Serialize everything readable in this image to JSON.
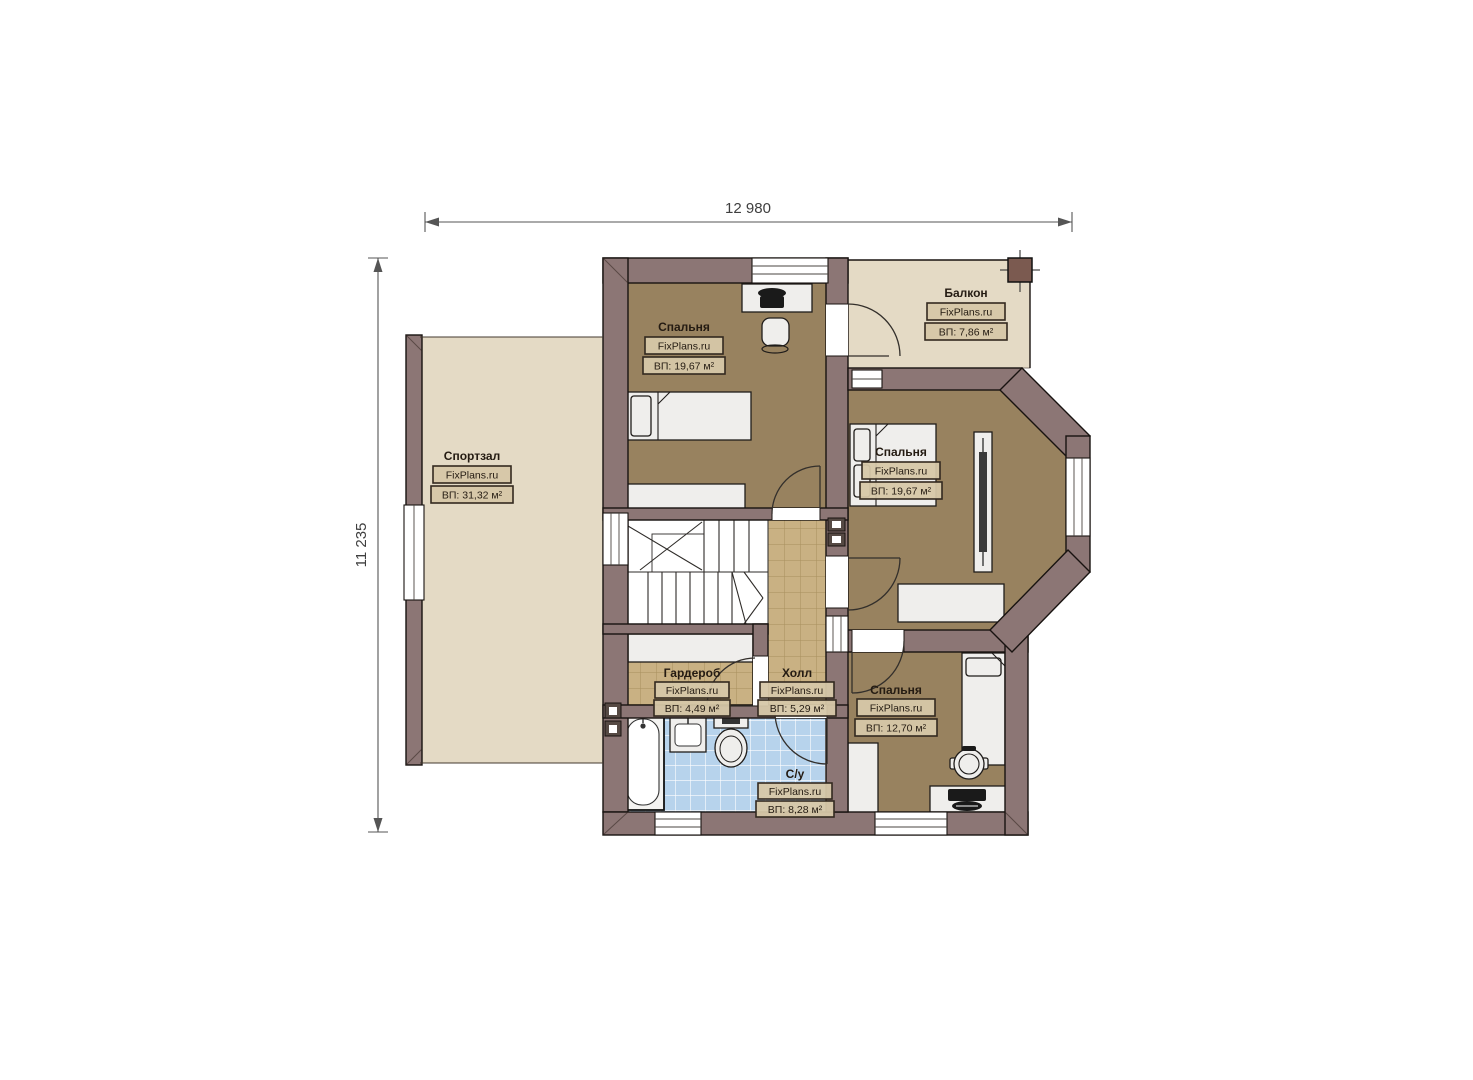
{
  "dimensions": {
    "width_total": "12 980",
    "height_total": "11 235"
  },
  "rooms": [
    {
      "key": "gym",
      "name": "Спортзал",
      "brand": "FixPlans.ru",
      "area": "ВП: 31,32 м²"
    },
    {
      "key": "bedroom-top",
      "name": "Спальня",
      "brand": "FixPlans.ru",
      "area": "ВП: 19,67 м²"
    },
    {
      "key": "balcony",
      "name": "Балкон",
      "brand": "FixPlans.ru",
      "area": "ВП: 7,86 м²"
    },
    {
      "key": "bedroom-right",
      "name": "Спальня",
      "brand": "FixPlans.ru",
      "area": "ВП: 19,67 м²"
    },
    {
      "key": "wardrobe",
      "name": "Гардероб",
      "brand": "FixPlans.ru",
      "area": "ВП: 4,49 м²"
    },
    {
      "key": "hall",
      "name": "Холл",
      "brand": "FixPlans.ru",
      "area": "ВП: 5,29 м²"
    },
    {
      "key": "bedroom-bottom",
      "name": "Спальня",
      "brand": "FixPlans.ru",
      "area": "ВП: 12,70 м²"
    },
    {
      "key": "bathroom",
      "name": "С/у",
      "brand": "FixPlans.ru",
      "area": "ВП: 8,28 м²"
    }
  ],
  "colors": {
    "wall": "#8c7675",
    "floor_bedroom": "#98825f",
    "floor_light": "#e4dac5",
    "tile_tan": "#c9b183",
    "tile_blue": "#b7d3ec",
    "outline": "#181310"
  }
}
